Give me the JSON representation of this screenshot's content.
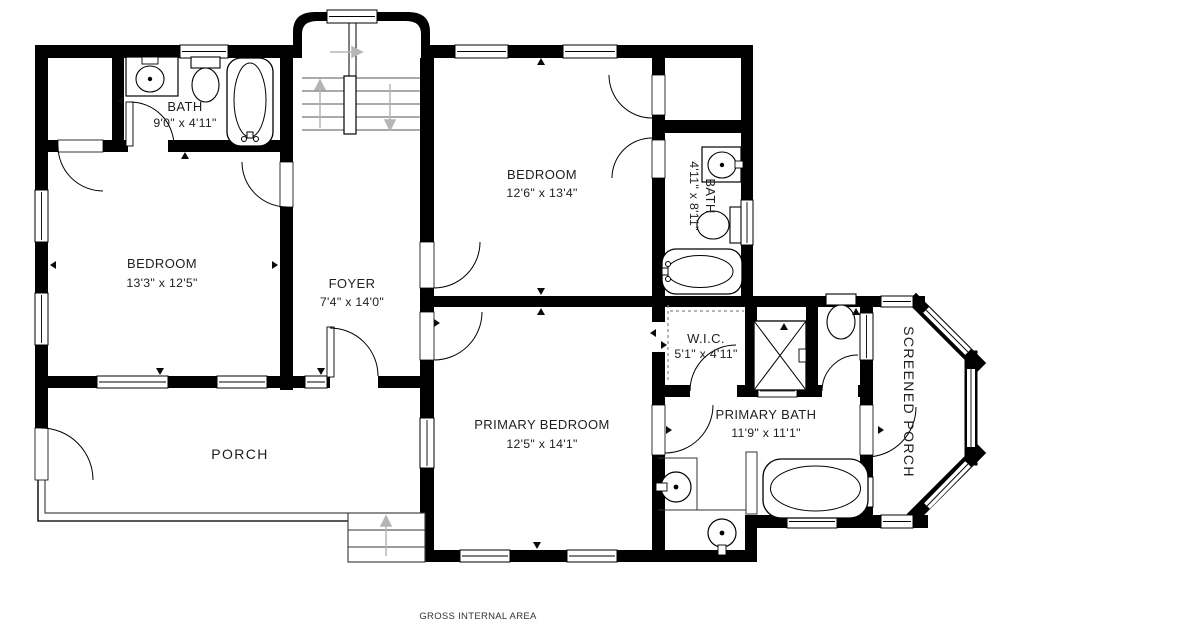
{
  "footer": {
    "label": "GROSS INTERNAL AREA"
  },
  "rooms": {
    "bath_upper_left": {
      "name": "BATH",
      "dims": "9'0\" x 4'11\""
    },
    "bedroom_left": {
      "name": "BEDROOM",
      "dims": "13'3\" x 12'5\""
    },
    "foyer": {
      "name": "FOYER",
      "dims": "7'4\" x 14'0\""
    },
    "bedroom_upper_right": {
      "name": "BEDROOM",
      "dims": "12'6\" x 13'4\""
    },
    "bath_right": {
      "name": "BATH",
      "dims": "4'11\" x 8'11\""
    },
    "wic": {
      "name": "W.I.C.",
      "dims": "5'1\" x 4'11\""
    },
    "primary_bedroom": {
      "name": "PRIMARY BEDROOM",
      "dims": "12'5\" x 14'1\""
    },
    "primary_bath": {
      "name": "PRIMARY BATH",
      "dims": "11'9\" x 11'1\""
    },
    "porch": {
      "name": "PORCH"
    },
    "screened_porch": {
      "name": "SCREENED PORCH"
    }
  },
  "colors": {
    "wall": "#000000",
    "background": "#ffffff",
    "label_text": "#1f1f1f",
    "stair_arrow": "#b5b5b5"
  },
  "fixtures": [
    "toilet",
    "sink",
    "bathtub",
    "shower",
    "stairs",
    "entry-steps",
    "closet-rod"
  ]
}
